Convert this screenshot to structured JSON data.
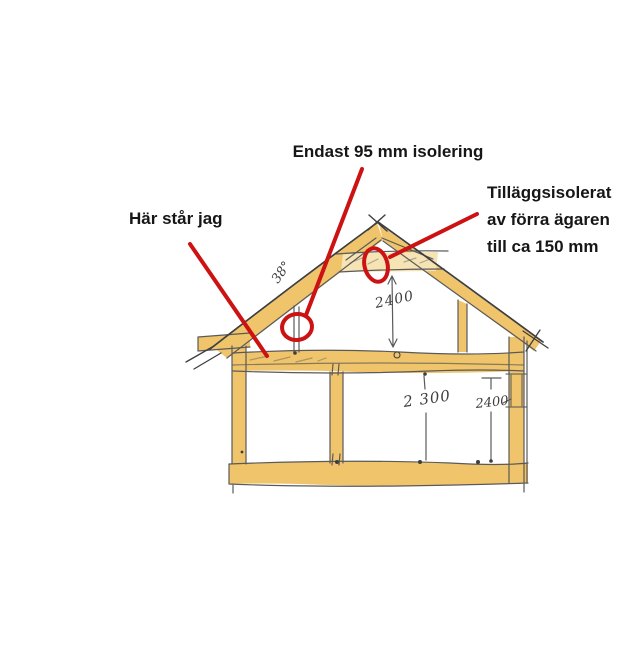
{
  "page": {
    "kind": "hand-drawn house cross-section sketch with red annotations",
    "background": "#ffffff"
  },
  "labels": {
    "insulation95": "Endast 95 mm isolering",
    "added_insulation_line1": "Tilläggsisolerat",
    "added_insulation_line2": "av förra ägaren",
    "added_insulation_line3": "till ca 150 mm",
    "here_i_stand": "Här står jag"
  },
  "sketch": {
    "roof_angle": "38°",
    "dim_attic_height": "2400",
    "dim_ground_height": "2 300",
    "dim_ground_height_right": "2400",
    "colors": {
      "wood": "#f0c46a",
      "wood_light": "#f7e4b4",
      "pencil": "#5a5a5a",
      "pencil_dark": "#3e3e3e",
      "annotation_red": "#cc1212",
      "label_text": "#161616"
    }
  }
}
